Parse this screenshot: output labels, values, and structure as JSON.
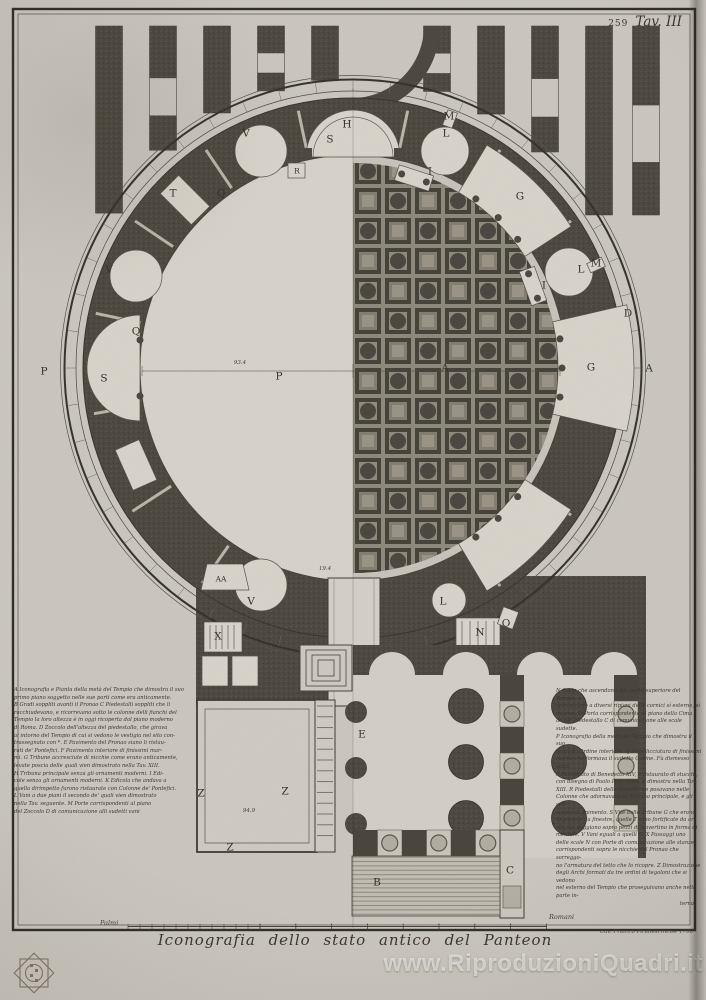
{
  "plate": {
    "number": "259",
    "label": "Tav. III"
  },
  "title": "Iconografia dello stato antico del Panteon",
  "scale": {
    "left": "Palmi",
    "right": "Romani"
  },
  "credit": "Cav. Fran.co Piranesi incise 1790",
  "watermark": "www.RiproduzioniQuadri.it",
  "colors": {
    "paper": "#cbc7bf",
    "ink": "#3b382f",
    "wall": "#4c473f",
    "light": "#d8d4cb",
    "coffer_bg": "#8e897c",
    "watermark": "#ffffff"
  },
  "legend": {
    "left_lines": [
      "A Iconografia e Pianta della metà del Tempio che dimostra il suo",
      "primo piano soggetto nelle sue parti come era anticamente.",
      "B Gradi soppliti avanti il Pronao C Piedestalli soppliti che li",
      "racchiudevano, e ricorrevano sotto le colonne delli fianchi del",
      "Tempio la loro altezza è in oggi ricoperta dal piano moderno",
      "di Roma. D Zoccolo dell'altezza del piedestallo, che girava",
      "al intorno del Tempio di cui si vedono le vestigia nel sito con-",
      "trassegnato con *. E Pavimento del Pronao siano li ristau-",
      "rati de' Pontefici. F Pavimento interiore di finissimi mar-",
      "mi. G Tribune accresciute di nicchie come erano anticamente,",
      "levate poscia delle quali vien dimostrato nella Tav. XIII.",
      "H Tribuna principale senza gli ornamenti moderni. I Edi-",
      "cole senza gli ornamenti moderni. K Edicola che andava a",
      "quella dirimpetto furono ristaurate con Colonne de' Pontefici.",
      "L Vani a due piani il secondo de' quali vien dimostrato",
      "nella Tav. seguente. M Porte corrispondenti al piano",
      "del Zoccolo D di comunicazione alli sudetti vani"
    ],
    "right_lines": [
      "N Scale che ascendono alla parte superiore del Tempio, e",
      "comunicano a diversi ripiani delle cornici sì esterne, sì",
      "interne. O Porta corrispondente al piano della Cima",
      "an del Piedestallo C di comunicazione alle scale sudette.",
      "P Iconografia della metà del Tempio che dimostra il suo",
      "secondo Ordine interiore. Q Impellicciatura di finissimi",
      "marmi che formava il sudetto Ordine. Fù dismesso sotto",
      "il Pontificato di Benedetto XIV, e ristaurato di stucchi,",
      "con disegno di Paolo Posi, come si dimostra nella Tav.",
      "XIII. R Piedestalli delle Cornici che posavano nelle",
      "Colonne che adornavano la Tribuna principale, e gli ser-",
      "vivano di finimento. S Vite delle Tribune G che erano",
      "illuminate da finestre, quelle T sono fortificate da ar-",
      "chi che poggiano sopra pezzi di travertino in forma di",
      "mensole. V Vani eguali a quelli G. X Passaggi uno",
      "delle scale N con Porte di comunicazione alle stanze",
      "corrispondenti sopra le nicchie del Pronao che sorreggo-",
      "no l'armatura del tetto che lo ricopre. Z Dimostrazione",
      "degli Archi formati da tre ordini di tegoloni che si vedono",
      "nel esterno del Tempio che proseguivano anche nella parte in-",
      "terna"
    ]
  },
  "plan": {
    "labels": [
      {
        "t": "H",
        "x": 347,
        "y": 124
      },
      {
        "t": "S",
        "x": 330,
        "y": 139
      },
      {
        "t": "R",
        "x": 297,
        "y": 171,
        "s": "sm"
      },
      {
        "t": "V",
        "x": 246,
        "y": 133
      },
      {
        "t": "T",
        "x": 173,
        "y": 193
      },
      {
        "t": "Q",
        "x": 221,
        "y": 193
      },
      {
        "t": "V",
        "x": 109,
        "y": 269
      },
      {
        "t": "Q",
        "x": 136,
        "y": 331
      },
      {
        "t": "S",
        "x": 104,
        "y": 378
      },
      {
        "t": "P",
        "x": 44,
        "y": 371
      },
      {
        "t": "P",
        "x": 279,
        "y": 376
      },
      {
        "t": "M",
        "x": 449,
        "y": 116
      },
      {
        "t": "L",
        "x": 446,
        "y": 133
      },
      {
        "t": "I",
        "x": 430,
        "y": 171
      },
      {
        "t": "G",
        "x": 520,
        "y": 196
      },
      {
        "t": "M",
        "x": 596,
        "y": 263
      },
      {
        "t": "L",
        "x": 581,
        "y": 269
      },
      {
        "t": "I",
        "x": 544,
        "y": 285
      },
      {
        "t": "D",
        "x": 628,
        "y": 313
      },
      {
        "t": "G",
        "x": 591,
        "y": 367
      },
      {
        "t": "A",
        "x": 649,
        "y": 368
      },
      {
        "t": "A",
        "x": 445,
        "y": 368
      },
      {
        "t": "AA",
        "x": 221,
        "y": 579,
        "s": "sm"
      },
      {
        "t": "X",
        "x": 218,
        "y": 636
      },
      {
        "t": "V",
        "x": 251,
        "y": 601
      },
      {
        "t": "L",
        "x": 443,
        "y": 601
      },
      {
        "t": "N",
        "x": 480,
        "y": 632
      },
      {
        "t": "O",
        "x": 506,
        "y": 623
      },
      {
        "t": "E",
        "x": 362,
        "y": 734
      },
      {
        "t": "Z",
        "x": 201,
        "y": 793
      },
      {
        "t": "Z",
        "x": 285,
        "y": 791
      },
      {
        "t": "Z",
        "x": 230,
        "y": 847
      },
      {
        "t": "B",
        "x": 377,
        "y": 882
      },
      {
        "t": "C",
        "x": 510,
        "y": 870
      }
    ],
    "dims": [
      {
        "t": "93.4",
        "x": 240,
        "y": 364
      },
      {
        "t": "94.9",
        "x": 249,
        "y": 812
      },
      {
        "t": "19.4",
        "x": 325,
        "y": 570
      }
    ]
  }
}
